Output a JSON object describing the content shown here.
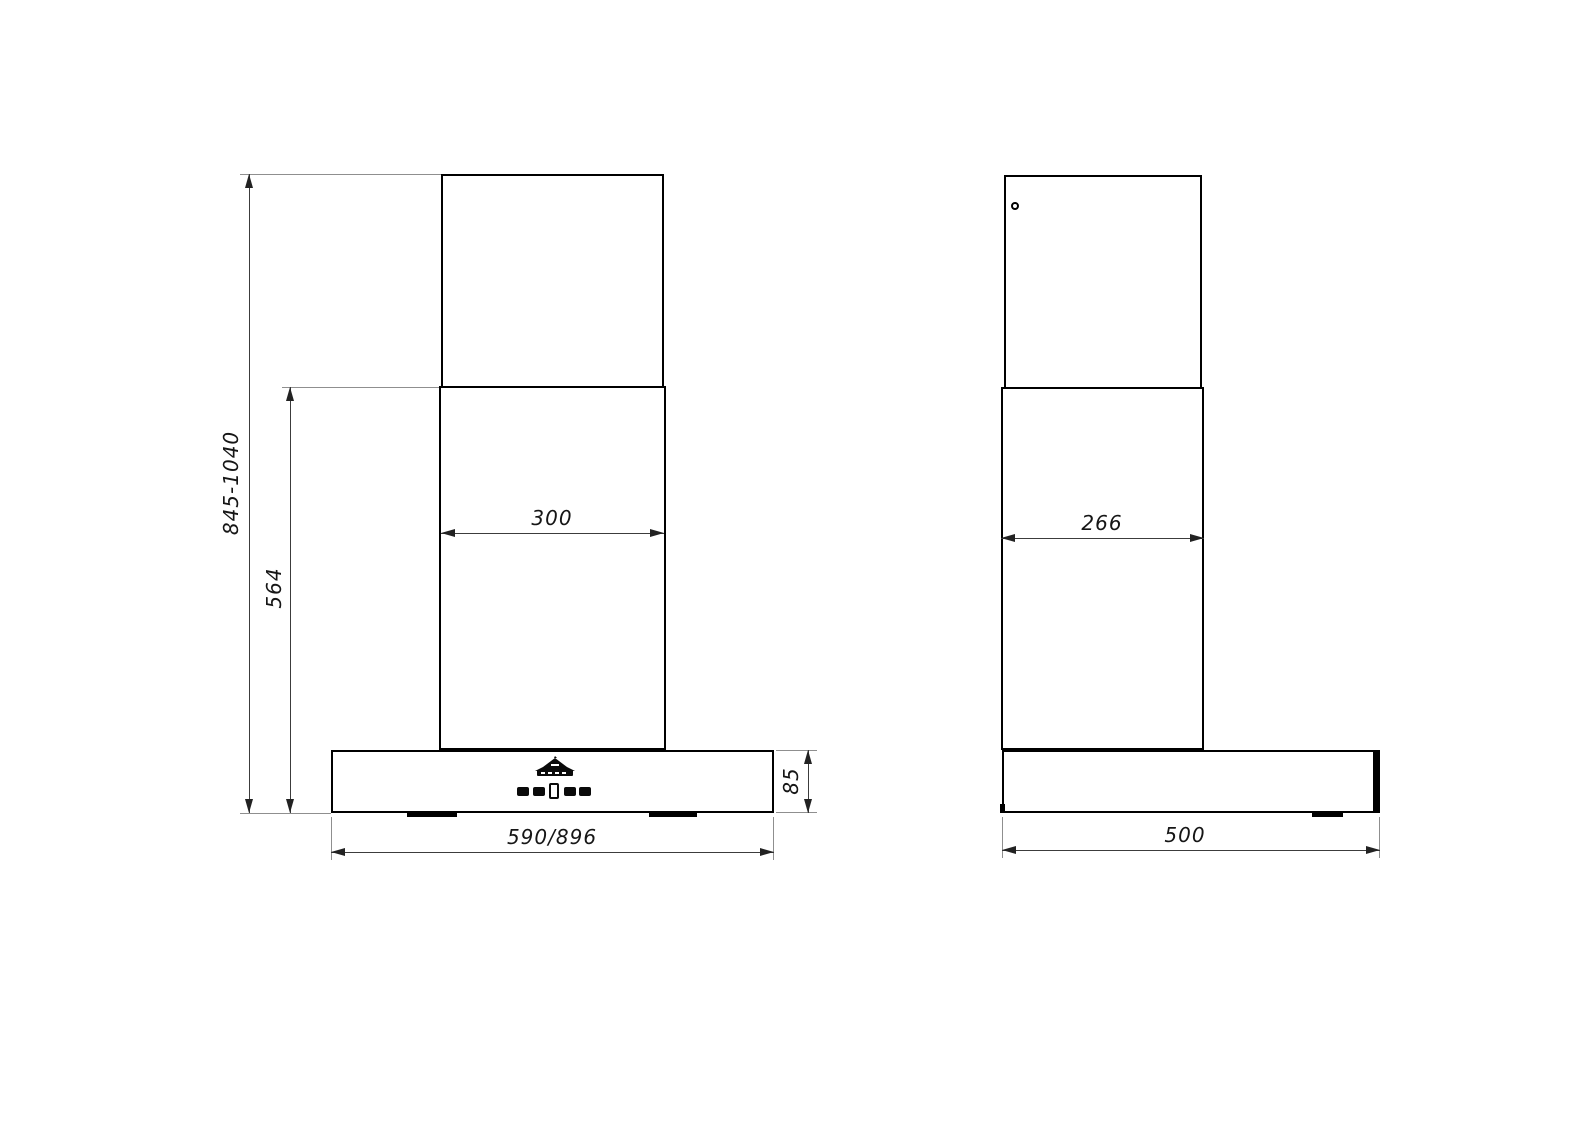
{
  "front_view": {
    "dim_overall_height": "845-1040",
    "dim_lower_section_height": "564",
    "dim_chimney_width": "300",
    "dim_body_width": "590/896",
    "dim_body_height": "85"
  },
  "side_view": {
    "dim_chimney_depth": "266",
    "dim_body_depth": "500"
  },
  "icons": {
    "logo": "brand-crown-logo",
    "buttons": "control-buttons",
    "display": "display-window",
    "screw": "screw-hole"
  }
}
